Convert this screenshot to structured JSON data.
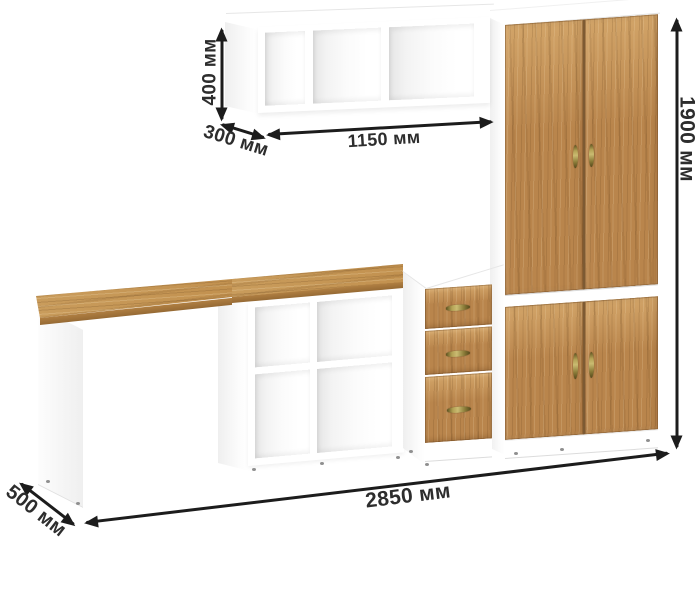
{
  "dimensions": {
    "shelf_height": "400 мм",
    "shelf_depth": "300 мм",
    "shelf_width": "1150 мм",
    "wardrobe_height": "1900 мм",
    "total_width": "2850 мм",
    "desk_depth": "500 мм"
  },
  "colors": {
    "background": "#ffffff",
    "annotation": "#1c1c1c",
    "label_text": "#2d2d2d",
    "wood_base": "#b9854c",
    "wood_light": "#d2a468",
    "wood_dark": "#8e6336",
    "desk_wood": "#c99c5c",
    "carcass_white": "#ffffff",
    "interior_shade": "#e6e6e6"
  },
  "furniture": {
    "wall_shelf": {
      "compartments": 3
    },
    "wardrobe": {
      "upper_doors": 2,
      "lower_doors": 2
    },
    "cube_shelf": {
      "compartments": 4
    },
    "drawer_unit": {
      "drawers": 3
    },
    "desk": {
      "legs": 2
    }
  }
}
